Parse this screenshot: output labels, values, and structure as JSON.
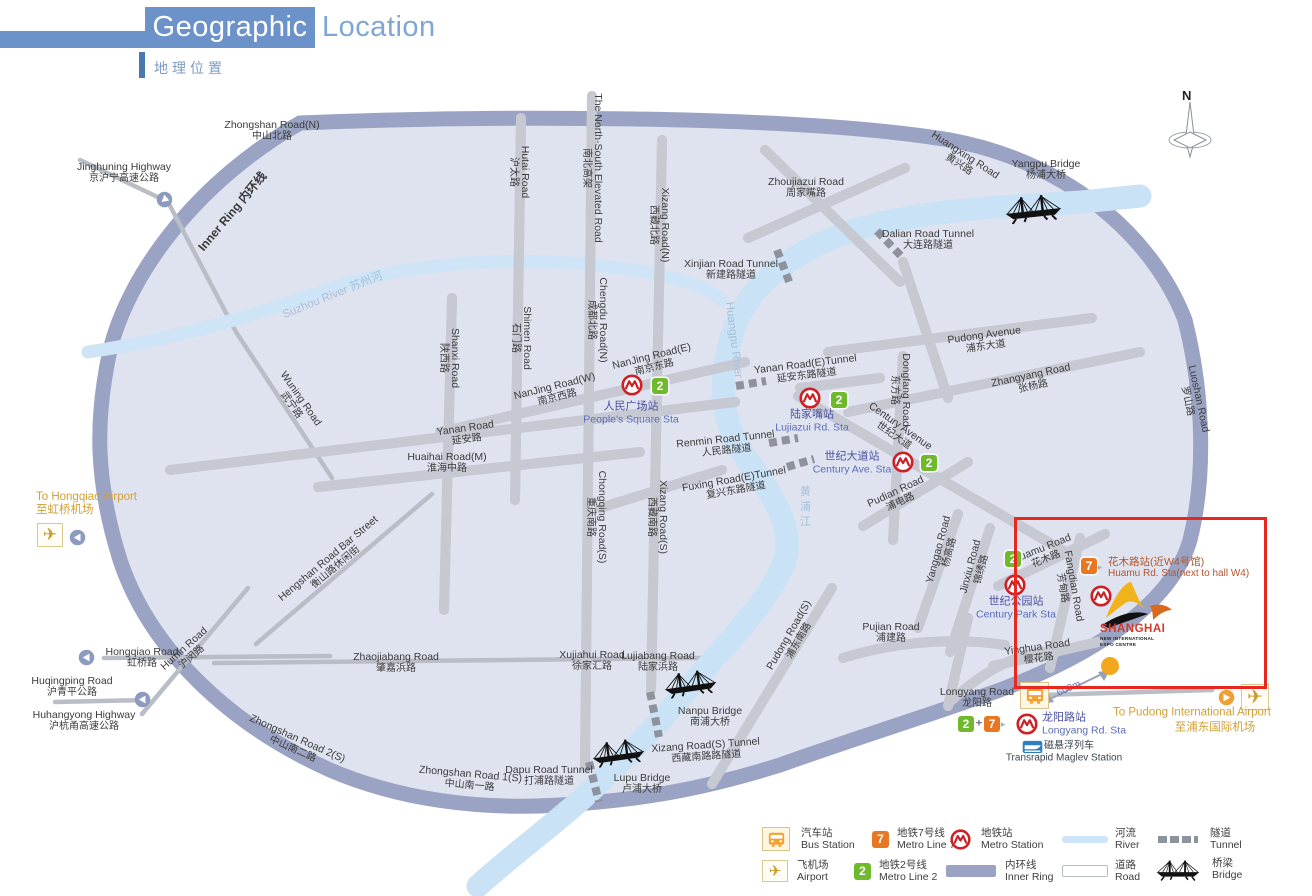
{
  "header": {
    "title_primary": "Geographic",
    "title_secondary": "Location",
    "subtitle": "地理位置"
  },
  "compass": {
    "label": "N"
  },
  "colors": {
    "title_blue": "#6b93c9",
    "inner_ring": "#9aa3c3",
    "river": "#cfe4f6",
    "metro_red": "#cc2127",
    "line2_green": "#6fb92c",
    "line7_orange": "#e87722",
    "gold": "#d2a135",
    "highlight_red": "#e8281e",
    "station_text": "#4a50a0",
    "huamu_text": "#b2542e"
  },
  "expo": {
    "name": "SHANGHAI",
    "line2": "NEW INTERNATIONAL",
    "line3": "EXPO CENTRE"
  },
  "legend": {
    "items": [
      {
        "icon": "bus-station-icon",
        "zh": "汽车站",
        "en": "Bus Station"
      },
      {
        "icon": "metro-line7-icon",
        "zh": "地铁7号线",
        "en": "Metro Line 7",
        "badge": "7"
      },
      {
        "icon": "metro-station-icon",
        "zh": "地铁站",
        "en": "Metro Station"
      },
      {
        "icon": "river-swatch",
        "zh": "河流",
        "en": "River"
      },
      {
        "icon": "tunnel-swatch",
        "zh": "隧道",
        "en": "Tunnel"
      },
      {
        "icon": "airport-icon",
        "zh": "飞机场",
        "en": "Airport"
      },
      {
        "icon": "metro-line2-icon",
        "zh": "地铁2号线",
        "en": "Metro Line 2",
        "badge": "2"
      },
      {
        "icon": "inner-ring-swatch",
        "zh": "内环线",
        "en": "Inner Ring"
      },
      {
        "icon": "road-swatch",
        "zh": "道路",
        "en": "Road"
      },
      {
        "icon": "bridge-icon",
        "zh": "桥梁",
        "en": "Bridge"
      }
    ]
  },
  "map": {
    "labels": [
      {
        "n": "zhongshan-road-n",
        "k": "rd",
        "x": 272,
        "y": 131,
        "en": "Zhongshan Road(N)",
        "zh": "中山北路"
      },
      {
        "n": "jinghuning-highway",
        "k": "rd",
        "x": 124,
        "y": 173,
        "en": "Jinghuning Highway",
        "zh": "京沪宁高速公路"
      },
      {
        "n": "hutai-road",
        "k": "rd",
        "x": 519,
        "y": 172,
        "r": 90,
        "en": "Hutai Road",
        "zh": "沪太路"
      },
      {
        "n": "north-south-elevated-road",
        "k": "rd",
        "x": 592,
        "y": 168,
        "r": 90,
        "en": "The North-South Elevated Road",
        "zh": "南北高架"
      },
      {
        "n": "xizang-road-n",
        "k": "rd",
        "x": 659,
        "y": 225,
        "r": 90,
        "en": "Xizang Road(N)",
        "zh": "西藏北路"
      },
      {
        "n": "zhoujiazui-road",
        "k": "rd",
        "x": 806,
        "y": 188,
        "en": "Zhoujiazui Road",
        "zh": "周家嘴路"
      },
      {
        "n": "xinjian-road-tunnel",
        "k": "rd",
        "x": 731,
        "y": 270,
        "en": "Xinjian Road Tunnel",
        "zh": "新建路隧道"
      },
      {
        "n": "dalian-road-tunnel",
        "k": "rd",
        "x": 928,
        "y": 240,
        "en": "Dalian Road Tunnel",
        "zh": "大连路隧道"
      },
      {
        "n": "yangpu-bridge",
        "k": "rd",
        "x": 1046,
        "y": 170,
        "en": "Yangpu Bridge",
        "zh": "杨浦大桥"
      },
      {
        "n": "huangxing-road",
        "k": "rd",
        "x": 962,
        "y": 160,
        "r": 33,
        "en": "Huangxing Road",
        "zh": "黄兴路"
      },
      {
        "n": "shanxi-road",
        "k": "rd",
        "x": 449,
        "y": 358,
        "r": 90,
        "en": "Shanxi Road",
        "zh": "陕西路"
      },
      {
        "n": "shimen-road",
        "k": "rd",
        "x": 521,
        "y": 338,
        "r": 90,
        "en": "Shimen Road",
        "zh": "石门路"
      },
      {
        "n": "chengdu-road-n",
        "k": "rd",
        "x": 597,
        "y": 320,
        "r": 90,
        "en": "Chengdu Road(N)",
        "zh": "成都北路"
      },
      {
        "n": "nanjing-road-w",
        "k": "rd",
        "x": 556,
        "y": 392,
        "r": -14,
        "en": "NanJing Road(W)",
        "zh": "南京西路"
      },
      {
        "n": "nanjing-road-e",
        "k": "rd",
        "x": 653,
        "y": 362,
        "r": -14,
        "en": "NanJing Road(E)",
        "zh": "南京东路"
      },
      {
        "n": "yanan-road-e-tunnel",
        "k": "rd",
        "x": 806,
        "y": 370,
        "r": -7,
        "en": "Yanan Road(E)Tunnel",
        "zh": "延安东路隧道"
      },
      {
        "n": "wuning-road",
        "k": "rd",
        "x": 296,
        "y": 402,
        "r": 55,
        "en": "Wuning Road",
        "zh": "武宁路"
      },
      {
        "n": "yanan-road",
        "k": "rd",
        "x": 466,
        "y": 434,
        "r": -8,
        "en": "Yanan Road",
        "zh": "延安路"
      },
      {
        "n": "huaihai-road-m",
        "k": "rd",
        "x": 447,
        "y": 463,
        "en": "Huaihai Road(M)",
        "zh": "淮海中路"
      },
      {
        "n": "renmin-road-tunnel",
        "k": "rd",
        "x": 726,
        "y": 445,
        "r": -6,
        "en": "Renmin Road Tunnel",
        "zh": "人民路隧道"
      },
      {
        "n": "fuxing-road-e-tunnel",
        "k": "rd",
        "x": 735,
        "y": 485,
        "r": -10,
        "en": "Fuxing Road(E)Tunnel",
        "zh": "复兴东路隧道"
      },
      {
        "n": "chongqing-road-s",
        "k": "rd",
        "x": 596,
        "y": 517,
        "r": 90,
        "en": "Chongqing Road(S)",
        "zh": "重庆南路"
      },
      {
        "n": "xizang-road-s",
        "k": "rd",
        "x": 657,
        "y": 517,
        "r": 90,
        "en": "Xizang Road(S)",
        "zh": "西藏南路"
      },
      {
        "n": "hengshan-road-bar-street",
        "k": "rd",
        "x": 332,
        "y": 563,
        "r": -40,
        "en": "Hengshan Road Bar Street",
        "zh": "衡山路休闲街"
      },
      {
        "n": "dongfang-road",
        "k": "rd",
        "x": 900,
        "y": 390,
        "r": 90,
        "en": "Dongfang Road",
        "zh": "东方路"
      },
      {
        "n": "pudong-avenue",
        "k": "rd",
        "x": 985,
        "y": 341,
        "r": -8,
        "en": "Pudong Avenue",
        "zh": "浦东大道"
      },
      {
        "n": "zhangyang-road",
        "k": "rd",
        "x": 1032,
        "y": 381,
        "r": -12,
        "en": "Zhangyang Road",
        "zh": "张杨路"
      },
      {
        "n": "century-avenue",
        "k": "rd",
        "x": 897,
        "y": 431,
        "r": 35,
        "en": "Century Avenue",
        "zh": "世纪大道"
      },
      {
        "n": "pudian-road",
        "k": "rd",
        "x": 898,
        "y": 497,
        "r": -25,
        "en": "Pudian Road",
        "zh": "浦电路"
      },
      {
        "n": "yanggao-road",
        "k": "rd",
        "x": 944,
        "y": 551,
        "r": -75,
        "en": "Yanggao Road",
        "zh": "杨高路"
      },
      {
        "n": "jinxiu-road",
        "k": "rd",
        "x": 976,
        "y": 568,
        "r": -75,
        "en": "Jinxiu Road",
        "zh": "锦绣路"
      },
      {
        "n": "pudong-road-s",
        "k": "rd",
        "x": 794,
        "y": 638,
        "r": -60,
        "en": "Pudong Road(S)",
        "zh": "浦东南路"
      },
      {
        "n": "pujian-road",
        "k": "rd",
        "x": 891,
        "y": 633,
        "en": "Pujian Road",
        "zh": "浦建路"
      },
      {
        "n": "longyang-road",
        "k": "rd",
        "x": 977,
        "y": 698,
        "en": "Longyang Road",
        "zh": "龙阳路"
      },
      {
        "n": "huamu-road",
        "k": "rd",
        "x": 1044,
        "y": 554,
        "r": -22,
        "en": "Huamu Road",
        "zh": "花木路"
      },
      {
        "n": "fangdian-road",
        "k": "rd",
        "x": 1068,
        "y": 587,
        "r": 80,
        "en": "Fangdian Road",
        "zh": "芳甸路"
      },
      {
        "n": "yinghua-road",
        "k": "rd",
        "x": 1038,
        "y": 653,
        "r": -8,
        "en": "Yinghua Road",
        "zh": "樱花路"
      },
      {
        "n": "zhaojiabang-road",
        "k": "rd",
        "x": 396,
        "y": 663,
        "en": "Zhaojiabang Road",
        "zh": "肇嘉浜路"
      },
      {
        "n": "xujiahui-road",
        "k": "rd",
        "x": 592,
        "y": 661,
        "en": "Xujiahui Road",
        "zh": "徐家汇路"
      },
      {
        "n": "lujiabang-road",
        "k": "rd",
        "x": 658,
        "y": 662,
        "en": "Lujiabang Road",
        "zh": "陆家浜路"
      },
      {
        "n": "nanpu-bridge",
        "k": "rd",
        "x": 710,
        "y": 717,
        "en": "Nanpu Bridge",
        "zh": "南浦大桥"
      },
      {
        "n": "xizang-road-s-tunnel",
        "k": "rd",
        "x": 706,
        "y": 751,
        "r": -4,
        "en": "Xizang Road(S) Tunnel",
        "zh": "西藏南路路隧道"
      },
      {
        "n": "lupu-bridge",
        "k": "rd",
        "x": 642,
        "y": 784,
        "en": "Lupu Bridge",
        "zh": "卢浦大桥"
      },
      {
        "n": "dapu-road-tunnel",
        "k": "rd",
        "x": 549,
        "y": 776,
        "en": "Dapu Road Tunnel",
        "zh": "打浦路隧道"
      },
      {
        "n": "zhongshan-road-2s",
        "k": "rd",
        "x": 295,
        "y": 744,
        "r": 24,
        "en": "Zhongshan Road 2(S)",
        "zh": "中山南二路"
      },
      {
        "n": "zhongshan-road-1s",
        "k": "rd",
        "x": 470,
        "y": 780,
        "r": 5,
        "en": "Zhongshan Road 1(S)",
        "zh": "中山南一路"
      },
      {
        "n": "hongqiao-road",
        "k": "rd",
        "x": 142,
        "y": 658,
        "en": "Hongqiao Road",
        "zh": "虹桥路"
      },
      {
        "n": "humin-road",
        "k": "rd",
        "x": 188,
        "y": 653,
        "r": -42,
        "en": "Humin Road",
        "zh": "沪闵路"
      },
      {
        "n": "huqingping-road",
        "k": "rd",
        "x": 72,
        "y": 687,
        "en": "Huqingping Road",
        "zh": "沪青平公路"
      },
      {
        "n": "huhangyong-highway",
        "k": "rd",
        "x": 84,
        "y": 721,
        "en": "Huhangyong Highway",
        "zh": "沪杭甬高速公路"
      },
      {
        "n": "luoshan-road",
        "k": "rd",
        "x": 1193,
        "y": 400,
        "r": 78,
        "en": "Luoshan Road",
        "zh": "罗山路"
      },
      {
        "n": "inner-ring-label",
        "k": "ring",
        "x": 233,
        "y": 212,
        "r": -50,
        "t": "Inner Ring 内环线"
      },
      {
        "n": "suzhou-river-label",
        "k": "riv",
        "x": 333,
        "y": 296,
        "r": -22,
        "t": "Suzhou River 苏州河"
      },
      {
        "n": "huangpu-river-label",
        "k": "riv",
        "x": 733,
        "y": 340,
        "r": 83,
        "t": "Huangpu River"
      },
      {
        "n": "huangpu-river-label-zh",
        "k": "rivv",
        "x": 804,
        "y": 508,
        "t": "黄浦江"
      },
      {
        "n": "to-hongqiao-airport",
        "k": "gold",
        "a": "l",
        "x": 36,
        "y": 504,
        "en": "To Hongqiao Airport",
        "zh": "至虹桥机场"
      },
      {
        "n": "to-pudong-airport-en",
        "k": "gold1",
        "x": 1192,
        "y": 713,
        "t": "To Pudong International Airport"
      },
      {
        "n": "to-pudong-airport-zh",
        "k": "gold1",
        "x": 1215,
        "y": 728,
        "t": "至浦东国际机场"
      },
      {
        "n": "peoples-square-station",
        "k": "st",
        "x": 631,
        "y": 413,
        "zh": "人民广场站",
        "en": "People's Square Sta"
      },
      {
        "n": "lujiazui-station",
        "k": "st",
        "x": 812,
        "y": 421,
        "zh": "陆家嘴站",
        "en": "Lujiazui Rd. Sta"
      },
      {
        "n": "century-ave-station",
        "k": "st",
        "x": 852,
        "y": 463,
        "zh": "世纪大道站",
        "en": "Century Ave. Sta"
      },
      {
        "n": "century-park-station",
        "k": "st",
        "x": 1016,
        "y": 608,
        "zh": "世纪公园站",
        "en": "Century Park Sta"
      },
      {
        "n": "longyang-station",
        "k": "st",
        "a": "l",
        "x": 1042,
        "y": 724,
        "zh": "龙阳路站",
        "en": "Longyang Rd. Sta"
      },
      {
        "n": "huamu-station",
        "k": "rust",
        "a": "l",
        "x": 1108,
        "y": 568,
        "zh": "花木路站(近W4号馆)",
        "en": "Huamu Rd. Sta(next to hall W4)"
      },
      {
        "n": "maglev-station-zh",
        "k": "mag1",
        "a": "l",
        "x": 1044,
        "y": 746,
        "t": "磁悬浮列车"
      },
      {
        "n": "maglev-station-en",
        "k": "mag2",
        "x": 1064,
        "y": 758,
        "t": "Transrapid Maglev Station"
      },
      {
        "n": "line2-badge-peoples-square",
        "k": "b2",
        "x": 660,
        "y": 386,
        "t": "2"
      },
      {
        "n": "line2-badge-lujiazui",
        "k": "b2",
        "x": 839,
        "y": 400,
        "t": "2"
      },
      {
        "n": "line2-badge-century-ave",
        "k": "b2",
        "x": 929,
        "y": 463,
        "t": "2"
      },
      {
        "n": "line2-badge-century-park",
        "k": "b2",
        "x": 1013,
        "y": 559,
        "t": "2"
      },
      {
        "n": "line7-badge-huamu",
        "k": "b7",
        "x": 1089,
        "y": 566,
        "t": "7"
      },
      {
        "n": "arrow-right-small-huamu",
        "k": "tri",
        "x": 1100,
        "y": 567,
        "t": "▸"
      },
      {
        "n": "line2-badge-longyang",
        "k": "b2",
        "x": 966,
        "y": 724,
        "t": "2"
      },
      {
        "n": "plus-sign-longyang",
        "k": "plus",
        "x": 979,
        "y": 724,
        "t": "+"
      },
      {
        "n": "line7-badge-longyang",
        "k": "b7",
        "x": 992,
        "y": 724,
        "t": "7"
      },
      {
        "n": "arrow-right-small-longyang",
        "k": "tri",
        "x": 1003,
        "y": 724,
        "t": "▸"
      },
      {
        "n": "distance-600m",
        "k": "m600",
        "x": 1069,
        "y": 689,
        "r": -24,
        "t": "600m"
      }
    ]
  }
}
